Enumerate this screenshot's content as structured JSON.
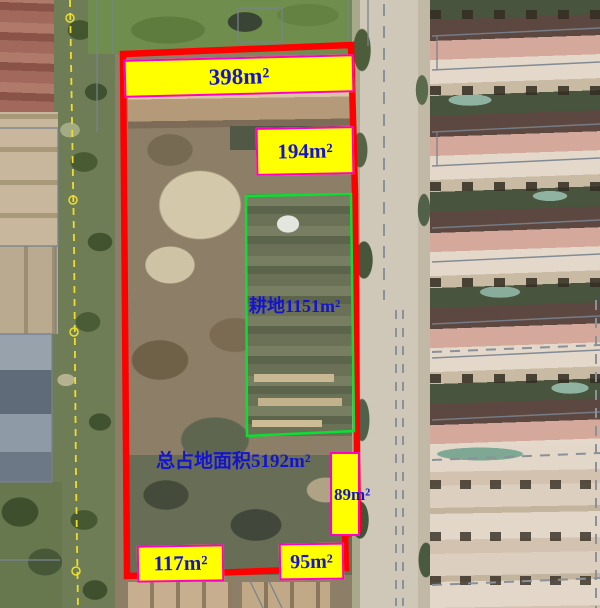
{
  "map": {
    "kind": "annotated aerial land-survey image",
    "colors": {
      "site_boundary": "#ff0000",
      "plot_outline": "#0ae032",
      "label_background": "#ffff00",
      "label_border": "#ff00c8",
      "label_text": "#1414cf",
      "survey_line": "#eedd2e",
      "cadastral_line": "#78828e"
    }
  },
  "annotations": {
    "total_area_label": "总占地面积5192m²",
    "plot_label": "耕地1151m²",
    "area_labels": {
      "top": "398m²",
      "upper_right": "194m²",
      "right": "89m²",
      "bottom_left": "117m²",
      "bottom_right": "95m²"
    }
  }
}
